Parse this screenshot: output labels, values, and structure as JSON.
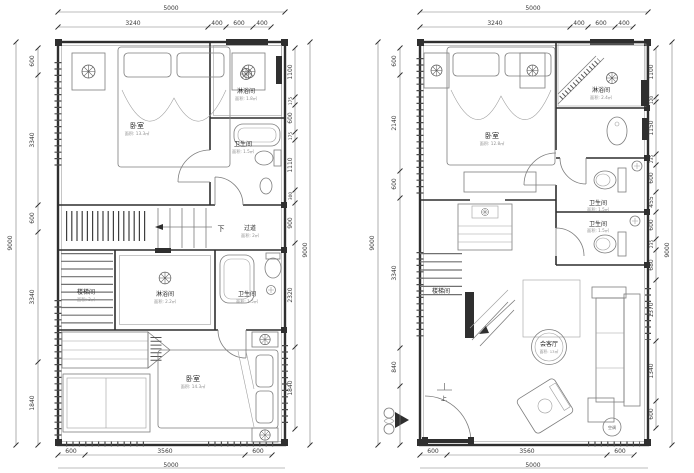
{
  "left_plan": {
    "dims": {
      "top_overall": "5000",
      "top_segments": [
        "3240",
        "400",
        "600",
        "400"
      ],
      "left_overall": "9000",
      "left_segments": [
        "600",
        "3340",
        "600",
        "3340",
        "1840"
      ],
      "right_overall": "9000",
      "right_segments": [
        "1100",
        "175",
        "600",
        "175",
        "1110",
        "300",
        "900",
        "2320",
        "1840"
      ],
      "bottom_overall": "5000",
      "bottom_segments": [
        "600",
        "3560",
        "600"
      ]
    },
    "rooms": {
      "bedroom_top": {
        "label": "卧室",
        "area": "面积: 13.3㎡"
      },
      "shower_top": {
        "label": "淋浴间",
        "area": "面积: 1.8㎡"
      },
      "bath_top": {
        "label": "卫生间",
        "area": "面积: 1.5㎡"
      },
      "corridor": {
        "label": "过道",
        "area": "面积: 2㎡",
        "direction": "下"
      },
      "stairwell": {
        "label": "楼梯间",
        "area": "面积: 3㎡"
      },
      "shower_mid": {
        "label": "淋浴间",
        "area": "面积: 2.2㎡"
      },
      "bath_mid": {
        "label": "卫生间",
        "area": "面积: 1.5㎡"
      },
      "bedroom_bottom": {
        "label": "卧室",
        "area": "面积: 14.3㎡"
      }
    }
  },
  "right_plan": {
    "dims": {
      "top_overall": "5000",
      "top_segments": [
        "3240",
        "400",
        "600",
        "400"
      ],
      "left_overall": "9000",
      "left_segments": [
        "600",
        "2140",
        "600",
        "3340",
        "840"
      ],
      "right_overall": "9000",
      "right_segments": [
        "1100",
        "120",
        "1150",
        "235",
        "600",
        "455",
        "600",
        "235",
        "680",
        "1370",
        "1340",
        "600"
      ],
      "bottom_overall": "5000",
      "bottom_segments": [
        "600",
        "3560",
        "600"
      ]
    },
    "rooms": {
      "bedroom": {
        "label": "卧室",
        "area": "面积: 12.8㎡"
      },
      "shower": {
        "label": "淋浴间",
        "area": "面积: 2.4㎡"
      },
      "bath_upper": {
        "label": "卫生间",
        "area": "面积: 1.5㎡"
      },
      "bath_lower": {
        "label": "卫生间",
        "area": "面积: 1.5㎡"
      },
      "stairwell": {
        "label": "楼梯间",
        "direction": "上"
      },
      "living": {
        "label": "会客厅",
        "area": "面积: 13㎡"
      },
      "ac": {
        "label": "空调"
      }
    }
  }
}
